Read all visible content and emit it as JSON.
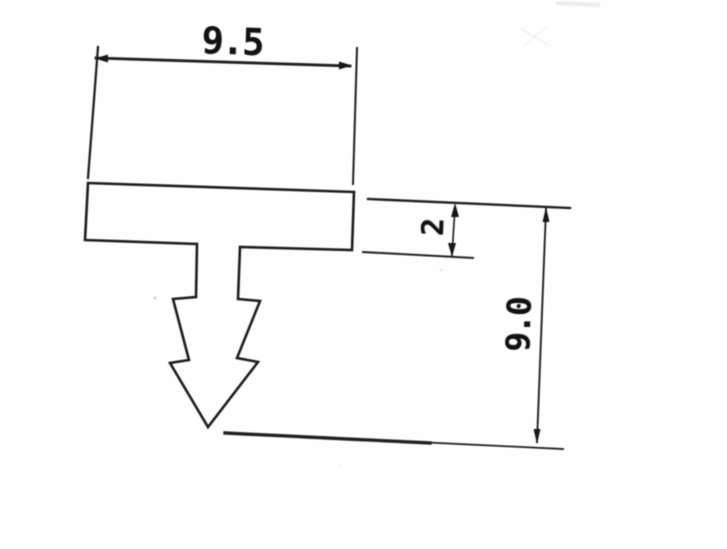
{
  "drawing": {
    "description_labels": {},
    "dimensions": {
      "width": {
        "value": "9.5",
        "orientation": "horizontal"
      },
      "thickness": {
        "value": "2",
        "orientation": "vertical"
      },
      "height": {
        "value": "9.0",
        "orientation": "vertical"
      }
    },
    "colors": {
      "ink": "#282828",
      "paper": "#fefefe"
    }
  }
}
